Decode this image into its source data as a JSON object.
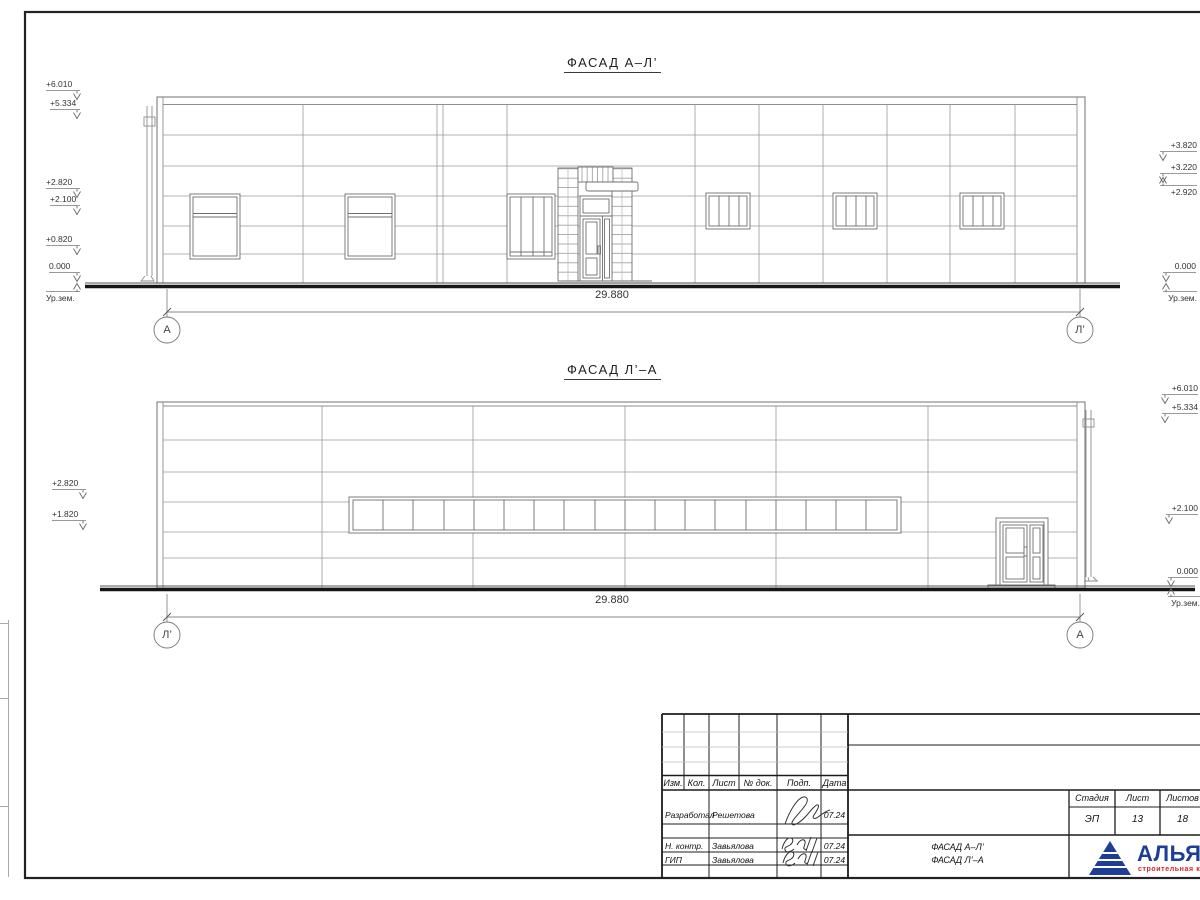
{
  "titles": {
    "facade_top": "ФАСАД А–Л’",
    "facade_bottom": "ФАСАД Л’–А"
  },
  "dimensions": {
    "top": "29.880",
    "bottom": "29.880"
  },
  "axes": {
    "top_left": "А",
    "top_right": "Л’",
    "bottom_left": "Л’",
    "bottom_right": "А"
  },
  "elevations": {
    "top_left": [
      "+6.010",
      "+5.334",
      "+2.820",
      "+2.100",
      "+0.820",
      "0.000",
      "Ур.зем."
    ],
    "top_right": [
      "+3.820",
      "+3.220",
      "+2.920",
      "0.000",
      "Ур.зем."
    ],
    "bottom_left": [
      "+2.820",
      "+1.820"
    ],
    "bottom_right": [
      "+6.010",
      "+5.334",
      "+2.100",
      "0.000",
      "Ур.зем."
    ]
  },
  "title_block": {
    "columns": [
      "Изм.",
      "Кол.",
      "Лист",
      "№ док.",
      "Подп.",
      "Дата"
    ],
    "rows": [
      {
        "role": "Разработал",
        "name": "Решетова",
        "date": "07.24"
      },
      {
        "role": "Н. контр.",
        "name": "Завьялова",
        "date": "07.24"
      },
      {
        "role": "ГИП",
        "name": "Завьялова",
        "date": "07.24"
      }
    ],
    "doc_name_line1": "ФАСАД А–Л’",
    "doc_name_line2": "ФАСАД Л’–А",
    "stage": {
      "headers": [
        "Стадия",
        "Лист",
        "Листов"
      ],
      "values": [
        "ЭП",
        "13",
        "18"
      ]
    },
    "logo": {
      "name": "АЛЬЯНС",
      "subtitle": "строительная компания",
      "color": "#1d3e94",
      "accent": "#d2232a"
    }
  }
}
